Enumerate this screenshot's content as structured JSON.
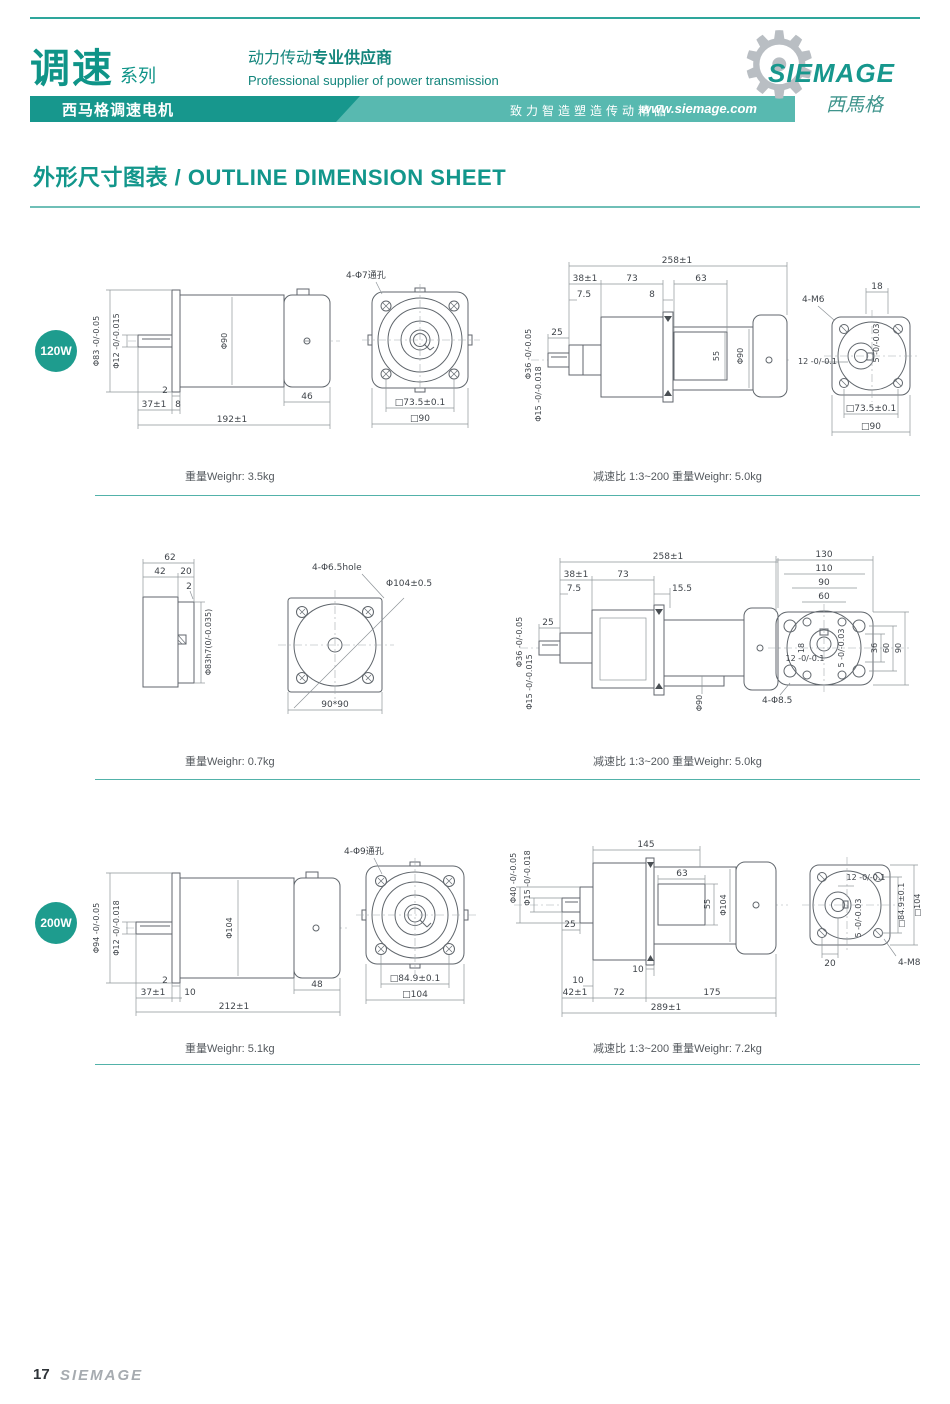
{
  "colors": {
    "teal": "#17978d",
    "teal_light": "#58b9b0",
    "badge": "#1e9c8e",
    "top_rule": "#2ea69c",
    "divider": "#52b2a9",
    "drawing_line": "#60666c",
    "footer_gray": "#a6abb0"
  },
  "header": {
    "series_title": "调速",
    "series_suffix": "系列",
    "tagline_cn_regular": "动力传动",
    "tagline_cn_bold": "专业供应商",
    "tagline_en": "Professional supplier of power transmission",
    "banner_product": "西马格调速电机",
    "banner_slogan": "致力智造塑造传动精品",
    "banner_url": "www.siemage.com",
    "logo_name": "SIEMAGE",
    "logo_cn": "西馬格",
    "gear_glyph": "⚙"
  },
  "title": "外形尺寸图表 / OUTLINE DIMENSION SHEET",
  "sections": [
    {
      "badge": "120W",
      "caption_left": "重量Weighr: 3.5kg",
      "caption_right": "减速比 1:3~200  重量Weighr: 5.0kg",
      "motor_side": {
        "labels": [
          "Φ83 -0/-0.05",
          "Φ12 -0/-0.015",
          "Φ90",
          "2",
          "37±1",
          "8",
          "46",
          "192±1"
        ]
      },
      "flange_front": {
        "labels": [
          "4-Φ7通孔",
          "□73.5±0.1",
          "□90"
        ]
      },
      "gearmotor_side": {
        "labels": [
          "258±1",
          "38±1",
          "73",
          "63",
          "7.5",
          "8",
          "25",
          "Φ36 -0/-0.05",
          "Φ15 -0/-0.018",
          "55",
          "Φ90"
        ]
      },
      "gear_flange": {
        "labels": [
          "4-M6",
          "18",
          "12 -0/-0.1",
          "5 -0/-0.03",
          "□73.5±0.1",
          "□90"
        ]
      }
    },
    {
      "caption_left": "重量Weighr: 0.7kg",
      "caption_right": "减速比 1:3~200  重量Weighr: 5.0kg",
      "unit_side": {
        "labels": [
          "62",
          "42",
          "20",
          "2",
          "Φ83h7(0/-0.035)"
        ]
      },
      "flange_front": {
        "labels": [
          "4-Φ6.5hole",
          "Φ104±0.5",
          "90*90"
        ]
      },
      "gearmotor_side": {
        "labels": [
          "258±1",
          "38±1",
          "73",
          "15.5",
          "7.5",
          "25",
          "Φ36 -0/-0.05",
          "Φ15 -0/-0.015",
          "Φ90"
        ]
      },
      "foot_flange": {
        "labels": [
          "130",
          "110",
          "90",
          "60",
          "18",
          "12 -0/-0.1",
          "5 -0/-0.03",
          "36",
          "60",
          "90",
          "4-Φ8.5"
        ]
      }
    },
    {
      "badge": "200W",
      "caption_left": "重量Weighr: 5.1kg",
      "caption_right": "减速比 1:3~200  重量Weighr: 7.2kg",
      "motor_side": {
        "labels": [
          "Φ94 -0/-0.05",
          "Φ12 -0/-0.018",
          "Φ104",
          "2",
          "37±1",
          "10",
          "48",
          "212±1"
        ]
      },
      "flange_front": {
        "labels": [
          "4-Φ9通孔",
          "□84.9±0.1",
          "□104"
        ]
      },
      "gearmotor_side": {
        "labels": [
          "145",
          "Φ40 -0/-0.05",
          "Φ15 -0/-0.018",
          "63",
          "55",
          "Φ104",
          "25",
          "10",
          "10",
          "42±1",
          "72",
          "175",
          "289±1"
        ]
      },
      "gear_flange": {
        "labels": [
          "12 -0/-0.1",
          "5 -0/-0.03",
          "□84.9±0.1",
          "□104",
          "20",
          "4-M8"
        ]
      }
    }
  ],
  "footer": {
    "page_number": "17",
    "logo": "SIEMAGE"
  }
}
